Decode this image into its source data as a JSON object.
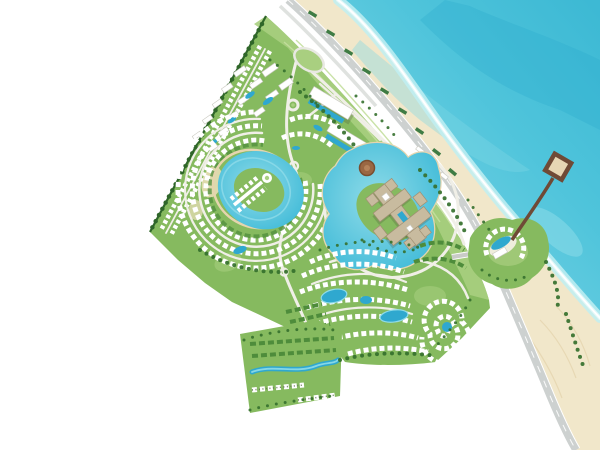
{
  "canvas": {
    "width": 600,
    "height": 450
  },
  "scene": {
    "kind": "resort-masterplan-rendering",
    "view": "top-down aerial site plan",
    "coastline_orientation": "diagonal, sea at top-right",
    "features": [
      {
        "id": "sea",
        "fill_key": "sea_mid"
      },
      {
        "id": "beach-sand-strip",
        "fill_key": "sand"
      },
      {
        "id": "coastal-highway",
        "fill_key": "highway"
      },
      {
        "id": "beach-cabanas",
        "fill_key": "cabana"
      },
      {
        "id": "pier-with-square-head",
        "fill_key": "pier"
      },
      {
        "id": "beach-club-circle",
        "fill_key": "green_base"
      },
      {
        "id": "main-resort-site",
        "fill_key": "green_base"
      },
      {
        "id": "entrance-district-apartments",
        "fill_key": "building"
      },
      {
        "id": "seafront-hotel-slabs-with-pools",
        "fill_key": "building"
      },
      {
        "id": "ring-lagoon-villa-district",
        "fill_key": "lagoon"
      },
      {
        "id": "central-hotel-island-lagoon",
        "fill_key": "lagoon"
      },
      {
        "id": "central-hotel-complex",
        "fill_key": "hotel_tan"
      },
      {
        "id": "crescent-townhouse-district",
        "fill_key": "building"
      },
      {
        "id": "spiral-villa-feature",
        "fill_key": "building"
      },
      {
        "id": "southwest-apartment-cluster",
        "fill_key": "building"
      }
    ]
  },
  "colors": {
    "sea_deep": "#3db9d4",
    "sea_mid": "#4fc4db",
    "sea_light": "#8fdde9",
    "sea_shallow": "#c9eff3",
    "foam": "#f4fbfc",
    "sand": "#f1e7ca",
    "sand_shade": "#e5d5ae",
    "highway": "#cdd1d0",
    "road_light": "#f0efe7",
    "road_gray": "#c9cbc6",
    "lane_marking": "#ffffff",
    "green_base": "#86ba5f",
    "green_light": "#a9cf80",
    "green_pale": "#c4df9f",
    "green_dark": "#4e8c3b",
    "tree": "#35702d",
    "hedge": "#2f6629",
    "lagoon": "#41bbd8",
    "lagoon_light": "#8fdbe8",
    "pool": "#2fa8cf",
    "building": "#ffffff",
    "building_shadow": "#c9c9c0",
    "hotel_tan": "#c8bb9f",
    "hotel_edge": "#a08f72",
    "pier": "#6f4a36",
    "plaza": "#9a6743",
    "cabana": "#3f7c44"
  }
}
